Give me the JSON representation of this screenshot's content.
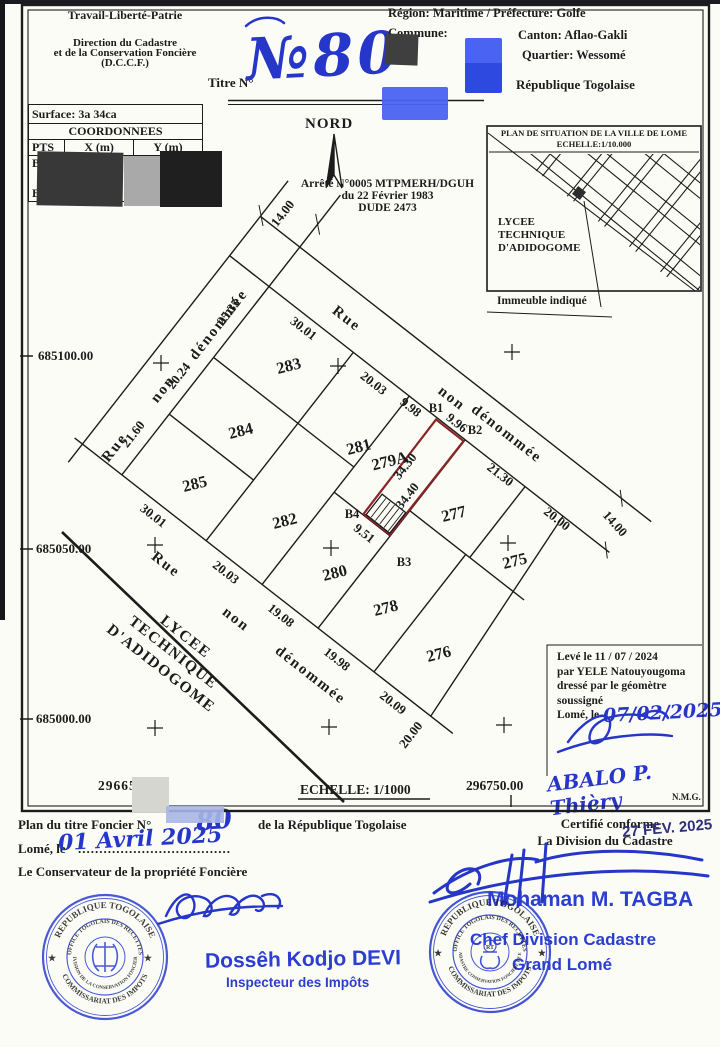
{
  "header": {
    "motto": "Travail-Liberté-Patrie",
    "agency_line1": "Direction du Cadastre",
    "agency_line2": "et de la Conservation Foncière",
    "agency_line3": "(D.C.C.F.)",
    "titre_label": "Titre N°",
    "titre_number": "№80",
    "region_line": "Région:  Maritime  /  Préfecture:  Golfe",
    "commune_label": "Commune:",
    "canton_line": "Canton:  Aflao-Gakli",
    "quartier_line": "Quartier:  Wessomé",
    "republique": "République  Togolaise"
  },
  "surface_table": {
    "surface": "Surface:  3a  34ca",
    "coordonnees_title": "COORDONNEES",
    "col_pts": "PTS",
    "col_x": "X (m)",
    "col_y": "Y (m)",
    "rows": [
      {
        "pt": "B1",
        "x": "2967",
        "y": "68"
      },
      {
        "pt": "B4",
        "x": "",
        "y": ""
      }
    ]
  },
  "north_label": "NORD",
  "arrete": {
    "line1": "Arrêté N°0005 MTPMERH/DGUH",
    "line2": "du 22 Février 1983",
    "line3": "DUDE 2473"
  },
  "inset": {
    "title": "PLAN DE SITUATION DE LA VILLE DE LOME",
    "scale": "ECHELLE:1/10.000",
    "lycee": [
      "LYCEE",
      "TECHNIQUE",
      "D'ADIDOGOME"
    ],
    "callout": "Immeuble indiqué"
  },
  "map": {
    "parcel_labels": [
      {
        "t": "283",
        "x": 290,
        "y": 371
      },
      {
        "t": "284",
        "x": 242,
        "y": 436
      },
      {
        "t": "285",
        "x": 196,
        "y": 489
      },
      {
        "t": "281",
        "x": 360,
        "y": 452
      },
      {
        "t": "282",
        "x": 286,
        "y": 526
      },
      {
        "t": "280",
        "x": 336,
        "y": 578
      },
      {
        "t": "278",
        "x": 387,
        "y": 613
      },
      {
        "t": "276",
        "x": 440,
        "y": 659
      },
      {
        "t": "279A",
        "x": 391,
        "y": 466
      },
      {
        "t": "277",
        "x": 455,
        "y": 519
      },
      {
        "t": "275",
        "x": 516,
        "y": 566
      }
    ],
    "measurements": [
      {
        "t": "30.01",
        "x": 53,
        "y": 16,
        "r": 0
      },
      {
        "t": "20.03",
        "x": 142,
        "y": 16,
        "r": 0
      },
      {
        "t": "9.98",
        "x": 186,
        "y": 12,
        "r": 0
      },
      {
        "t": "9.96",
        "x": 232,
        "y": -4,
        "r": 0
      },
      {
        "t": "21.30",
        "x": 298,
        "y": 10,
        "r": 0
      },
      {
        "t": "20.00",
        "x": 370,
        "y": 10,
        "r": 0
      },
      {
        "t": "14.00",
        "x": 418,
        "y": -22,
        "r": 10
      },
      {
        "t": "25.35",
        "x": -12,
        "y": 45,
        "r": -90
      },
      {
        "t": "20.24",
        "x": -12,
        "y": 126,
        "r": -90
      },
      {
        "t": "21.60",
        "x": -12,
        "y": 200,
        "r": -90
      },
      {
        "t": "14.00",
        "x": -30,
        "y": -66,
        "r": -90
      },
      {
        "t": "34.30",
        "x": 222,
        "y": 58,
        "r": -90
      },
      {
        "t": "34.40",
        "x": 242,
        "y": 80,
        "r": -90
      },
      {
        "t": "9.51",
        "x": 227,
        "y": 140,
        "r": 0
      },
      {
        "t": "30.01",
        "x": 50,
        "y": 256,
        "r": 0
      },
      {
        "t": "20.03",
        "x": 142,
        "y": 256,
        "r": 0
      },
      {
        "t": "19.08",
        "x": 212,
        "y": 256,
        "r": 0
      },
      {
        "t": "19.98",
        "x": 283,
        "y": 256,
        "r": 0
      },
      {
        "t": "20.09",
        "x": 354,
        "y": 256,
        "r": 0
      },
      {
        "t": "20.00",
        "x": 392,
        "y": 266,
        "r": -90
      }
    ],
    "street_names": [
      {
        "t": "Rue",
        "x": 81,
        "y": -18,
        "r": 0
      },
      {
        "t": "non",
        "x": 213,
        "y": -20,
        "r": 0
      },
      {
        "t": "dénommée",
        "x": 278,
        "y": -26,
        "r": 0
      },
      {
        "t": "Rue",
        "x": -18,
        "y": 222,
        "r": -90
      },
      {
        "t": "non",
        "x": -16,
        "y": 146,
        "r": -90
      },
      {
        "t": "dénommée",
        "x": -12,
        "y": 61,
        "r": -90
      },
      {
        "t": "Rue",
        "x": 90,
        "y": 287,
        "r": 0
      },
      {
        "t": "non",
        "x": 179,
        "y": 287,
        "r": 0
      },
      {
        "t": "dénommée",
        "x": 272,
        "y": 285,
        "r": 0
      }
    ],
    "lycee_lines": [
      {
        "t": "LYCEE",
        "x": 150,
        "y": 332
      },
      {
        "t": "TECHNIQUE",
        "x": 150,
        "y": 352
      },
      {
        "t": "D'ADIDOGOME",
        "x": 150,
        "y": 372
      }
    ],
    "point_labels": [
      {
        "t": "B1",
        "x": 436,
        "y": 412
      },
      {
        "t": "B2",
        "x": 475,
        "y": 434
      },
      {
        "t": "B3",
        "x": 404,
        "y": 566
      },
      {
        "t": "B4",
        "x": 352,
        "y": 518
      }
    ],
    "crosses": [
      [
        161,
        363
      ],
      [
        338,
        366
      ],
      [
        512,
        352
      ],
      [
        155,
        545
      ],
      [
        331,
        548
      ],
      [
        508,
        543
      ],
      [
        155,
        728
      ],
      [
        329,
        727
      ],
      [
        504,
        725
      ]
    ]
  },
  "grid": {
    "northing1": "685100.00",
    "northing2": "685050.00",
    "northing3": "685000.00",
    "easting_left": "29665",
    "easting_right": "296750.00",
    "scale": "ECHELLE:  1/1000"
  },
  "leve_block": {
    "l1": "Levé le 11 / 07 / 2024",
    "l2": "par YELE Natouyougoma",
    "l3": "dressé par le géomètre",
    "l4": "soussigné",
    "l5": "Lomé, le",
    "date_hand": "07/02/2025",
    "signature_name": "ABALO P. Thièry",
    "initials": "N.M.G."
  },
  "footer": {
    "plan_line_left": "Plan  du  titre  Foncier  N°",
    "plan_number_hand": "80",
    "plan_line_right": "de  la  République  Togolaise",
    "lome_le": "Lomé,  le",
    "dots": "....................................",
    "date_hand": "01  Avril  2025",
    "conservateur": "Le   Conservateur  de  la  propriété  Foncière",
    "certifie1": "Certifié  conforme",
    "certifie2": "La  Division  du  Cadastre",
    "stamp_date": "27 FEV. 2025",
    "inspecteur_name": "Dossêh Kodjo DEVI",
    "inspecteur_title": "Inspecteur des Impôts",
    "chef_name": "Mohaman M. TAGBA",
    "chef_title1": "Chef Division Cadastre",
    "chef_title2": "Grand Lomé"
  },
  "stamps": {
    "left": {
      "ring_top": "REPUBLIQUE TOGOLAISE",
      "ring_top_inner": "OFFICE TOGOLAIS DES RECETTES",
      "ring_bottom": "COMMISSARIAT DES IMPOTS",
      "ring_bottom_inner": "DIVISION DE LA CONSERVATION FONCIERE"
    },
    "right": {
      "ring_top": "REPUBLIQUE TOGOLAISE",
      "ring_top_inner": "OFFICE TOGOLAIS DES RECETTES",
      "ring_bottom": "COMMISSARIAT DES IMPOTS",
      "ring_bottom_inner": "DIR. CADASTRE CONSERVATION FONCIERE ET ENREG.",
      "center": "RT"
    }
  },
  "colors": {
    "ink": "#1c1c1c",
    "blue_hand": "#2636c8",
    "stamp_blue": "#2b3ecf",
    "parcel_red": "#8a2525"
  }
}
